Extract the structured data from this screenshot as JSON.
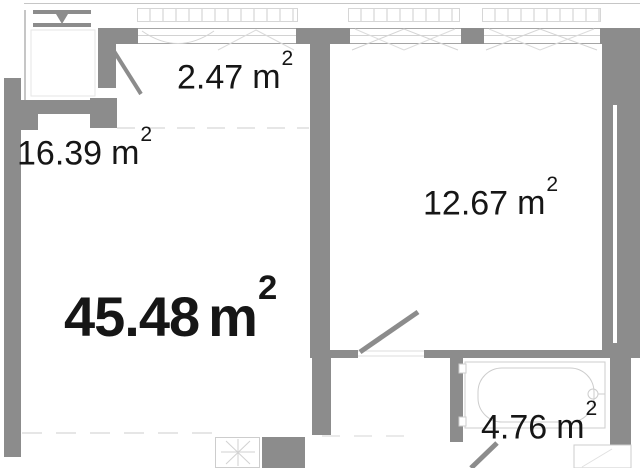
{
  "floorplan": {
    "total": {
      "value": "45.48",
      "unit": "m",
      "sup": "2"
    },
    "rooms": [
      {
        "value": "2.47",
        "unit": "m",
        "sup": "2"
      },
      {
        "value": "16.39",
        "unit": "m",
        "sup": "2"
      },
      {
        "value": "12.67",
        "unit": "m",
        "sup": "2"
      },
      {
        "value": "4.76",
        "unit": "m",
        "sup": "2"
      }
    ],
    "colors": {
      "wall": "#8c8c8c",
      "fixture_line": "#cdcdcd",
      "dashed_zone_line": "#e6e6e6",
      "text": "#161616",
      "background": "#ffffff"
    }
  }
}
